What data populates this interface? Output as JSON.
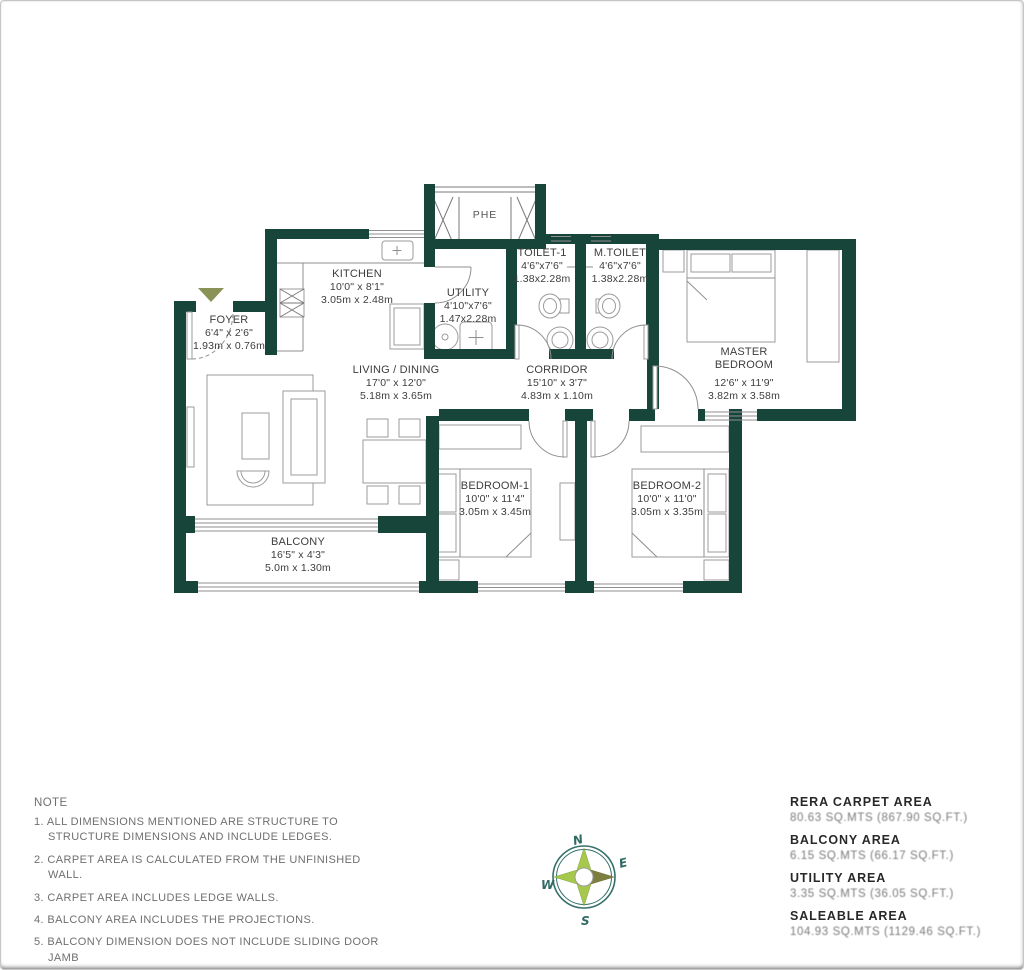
{
  "plan": {
    "shaft_label": "PHE",
    "rooms": {
      "foyer": {
        "name": "FOYER",
        "ft": "6'4\" x 2'6\"",
        "m": "1.93m x 0.76m"
      },
      "kitchen": {
        "name": "KITCHEN",
        "ft": "10'0\" x 8'1\"",
        "m": "3.05m x 2.48m"
      },
      "utility": {
        "name": "UTILITY",
        "ft": "4'10\"x7'6\"",
        "m": "1.47x2.28m"
      },
      "toilet1": {
        "name": "TOILET-1",
        "ft": "4'6\"x7'6\"",
        "m": "1.38x2.28m"
      },
      "mtoilet": {
        "name": "M.TOILET",
        "ft": "4'6\"x7'6\"",
        "m": "1.38x2.28m"
      },
      "master": {
        "name_line1": "MASTER",
        "name_line2": "BEDROOM",
        "ft": "12'6\" x 11'9\"",
        "m": "3.82m x 3.58m"
      },
      "living": {
        "name": "LIVING / DINING",
        "ft": "17'0\" x 12'0\"",
        "m": "5.18m x 3.65m"
      },
      "corridor": {
        "name": "CORRIDOR",
        "ft": "15'10\" x 3'7\"",
        "m": "4.83m x 1.10m"
      },
      "bedroom1": {
        "name": "BEDROOM-1",
        "ft": "10'0\" x 11'4\"",
        "m": "3.05m x 3.45m"
      },
      "bedroom2": {
        "name": "BEDROOM-2",
        "ft": "10'0\" x 11'0\"",
        "m": "3.05m x 3.35m"
      },
      "balcony": {
        "name": "BALCONY",
        "ft": "16'5\" x 4'3\"",
        "m": "5.0m x 1.30m"
      }
    }
  },
  "notes": {
    "heading": "NOTE",
    "items": [
      "1. ALL DIMENSIONS MENTIONED ARE STRUCTURE TO STRUCTURE DIMENSIONS AND INCLUDE LEDGES.",
      "2. CARPET AREA IS CALCULATED FROM THE UNFINISHED WALL.",
      "3. CARPET AREA INCLUDES LEDGE WALLS.",
      "4. BALCONY AREA INCLUDES THE PROJECTIONS.",
      "5. BALCONY DIMENSION DOES NOT INCLUDE SLIDING DOOR JAMB"
    ]
  },
  "areas": {
    "items": [
      {
        "label": "RERA CARPET AREA",
        "value": "80.63 SQ.MTS (867.90 SQ.FT.)"
      },
      {
        "label": "BALCONY AREA",
        "value": "6.15 SQ.MTS (66.17 SQ.FT.)"
      },
      {
        "label": "UTILITY AREA",
        "value": "3.35 SQ.MTS (36.05 SQ.FT.)"
      },
      {
        "label": "SALEABLE AREA",
        "value": "104.93 SQ.MTS (1129.46 SQ.FT.)"
      }
    ]
  },
  "compass": {
    "north": "N",
    "east": "E",
    "south": "S",
    "west": "W"
  },
  "colors": {
    "wall": "#17453a",
    "accent_olive": "#8b9257",
    "compass_green": "#a6c94d",
    "compass_olive": "#7c7f3e"
  }
}
